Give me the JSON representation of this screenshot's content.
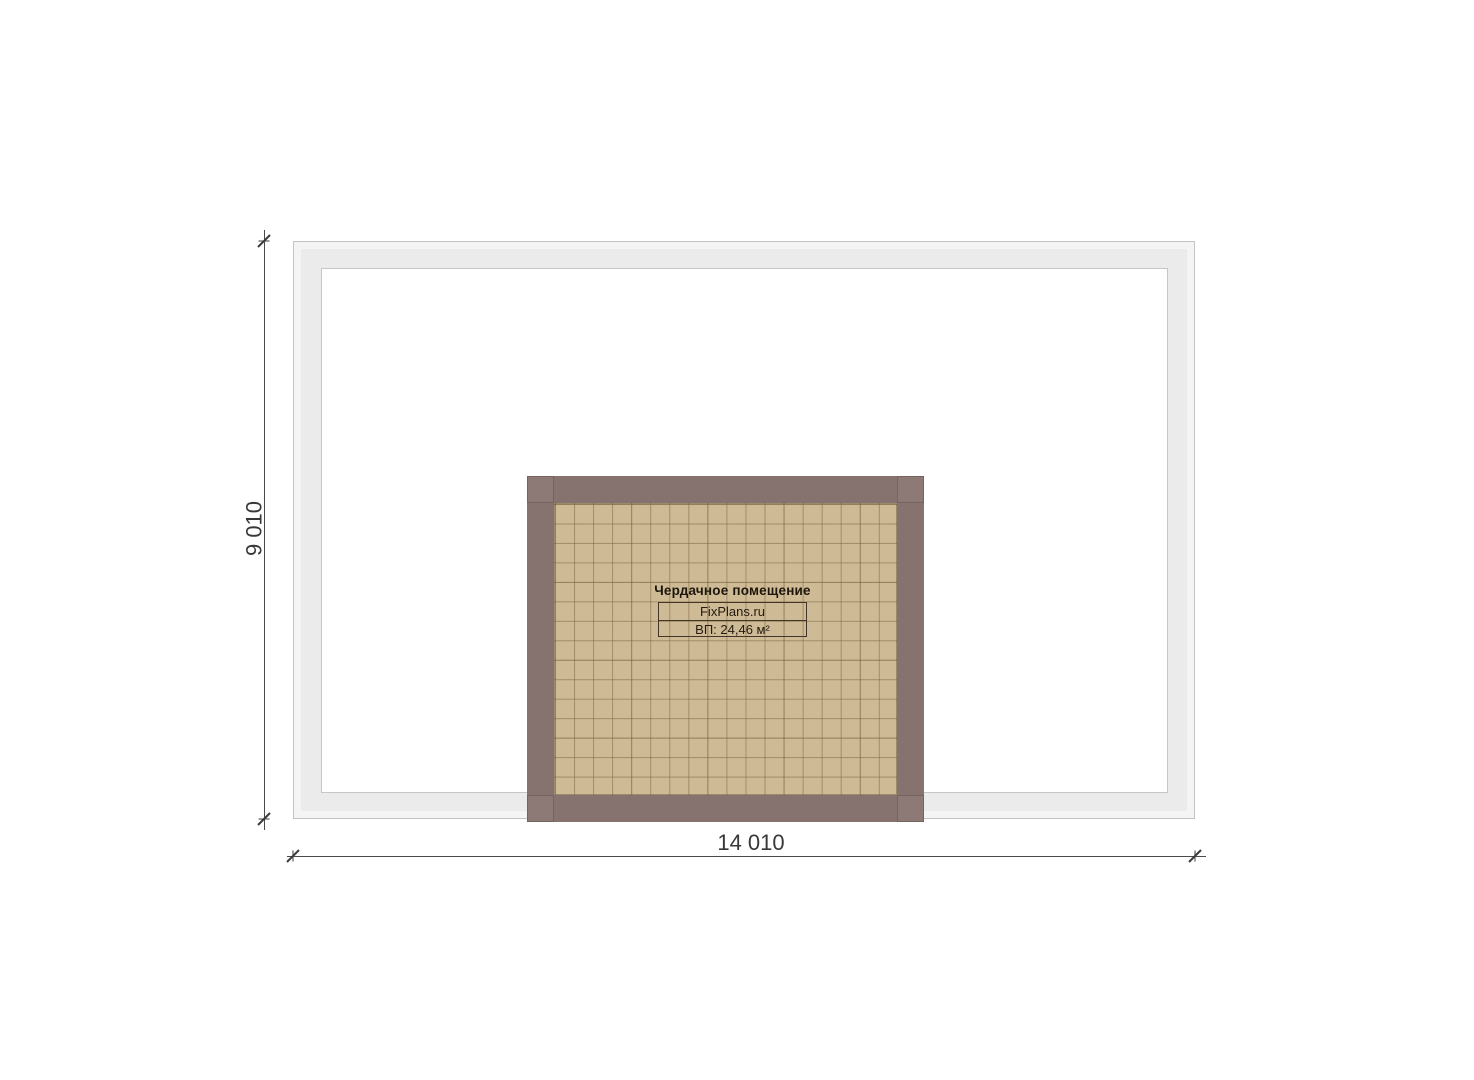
{
  "plan": {
    "attic_room": {
      "title": "Чердачное помещение",
      "watermark": "FixPlans.ru",
      "area": "ВП: 24,46 м²"
    },
    "dimensions": {
      "vertical": "9 010",
      "horizontal": "14 010"
    },
    "colors": {
      "wall_band_fill": "#ebebeb",
      "wall_band_outline": "#c3c3c3",
      "inner_floor": "#ffffff",
      "attic_wall": "#86726e",
      "attic_floor": "#cebb95",
      "grid_line": "#7a673f",
      "dimension_line": "#3c3c3c",
      "label_text": "#1d150c"
    }
  }
}
